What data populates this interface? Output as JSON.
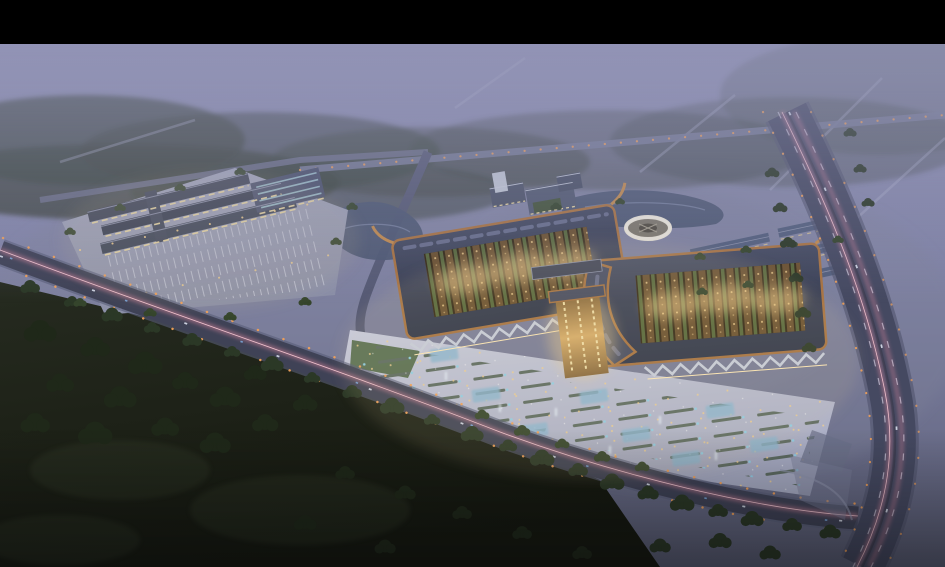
{
  "palette": {
    "frame": "#000000",
    "sky_top": "#9192b4",
    "sky_mid": "#7e81a4",
    "sky_low": "#5d6078",
    "fog": "#9294b6",
    "forest_dim": "#3d463f",
    "field": "#262b20",
    "field_dark": "#15180f",
    "tree_light": "#35452c",
    "tree_mid": "#2b3826",
    "tree_dark": "#1f2819",
    "ground_haze": "#7d8099",
    "platform": "#a5a9bf",
    "platform_low": "#8b8fa7",
    "roof_dark": "#3c4254",
    "roof_hi": "#454b61",
    "roof_lo": "#30364a",
    "roof_ridge": "#8d93ac",
    "louvre": "#6d7390",
    "copper": "#a87342",
    "copper_bright": "#c08a4e",
    "lattice_brown": "#6b5130",
    "lattice_dark": "#352a18",
    "roofgarden_green": "#57683c",
    "glow_warm": "#f2cf8e",
    "glow_warm_bright": "#ffe9b8",
    "lit_wall": "#ecd9a2",
    "canopy_gray": "#c9cedd",
    "canopy_shadow": "#7d86a0",
    "plaza_light": "#c9ccdf",
    "plaza_dark": "#a6aac2",
    "stall_dark": "#5d6b62",
    "stall_blue": "#8fd0e8",
    "skylight_blue": "#8cb7d3",
    "skylight_core": "#d9edf8",
    "pond": "#4e5873",
    "pond_light": "#7f89a6",
    "road_dark": "#3f4256",
    "road_mid": "#454961",
    "road_light": "#6e7290",
    "road_faint": "#aeb1cb",
    "trail_pink": "#ee8fa6",
    "trail_core": "#f8c9d4",
    "streetlight_orange": "#f0a058",
    "car_white": "#e2e8f4",
    "car_blue": "#7fb1e8",
    "ring_white": "#e8e3d4",
    "ring_base": "#7d786c",
    "ring_hub": "#514c42",
    "warehouse_roof": "#535f7d",
    "teal_skylight": "#9ec3cd",
    "gate_hi": "#d8ad6a",
    "gate_lo": "#8a6a3e",
    "lawn_green": "#46603c",
    "courtyard_green": "#44543a",
    "white_block": "#bfc5d2"
  },
  "scene": {
    "letterbox": {
      "position": "top"
    },
    "elements": [
      {
        "name": "misty-sky"
      },
      {
        "name": "distant-forest"
      },
      {
        "name": "faint-country-roads"
      },
      {
        "name": "north-road-with-streetlights"
      },
      {
        "name": "west-campus-with-parking"
      },
      {
        "name": "ponds"
      },
      {
        "name": "north-office-cluster"
      },
      {
        "name": "circular-pavilion"
      },
      {
        "name": "northeast-warehouse-rows"
      },
      {
        "name": "forecourt-plaza-with-stalls"
      },
      {
        "name": "market-hall-west"
      },
      {
        "name": "market-hall-east"
      },
      {
        "name": "central-gate-atrium"
      },
      {
        "name": "south-boulevard-with-light-trail"
      },
      {
        "name": "east-avenue-with-light-trails"
      },
      {
        "name": "south-meadow-and-trees"
      },
      {
        "name": "fog-overlay"
      }
    ]
  }
}
